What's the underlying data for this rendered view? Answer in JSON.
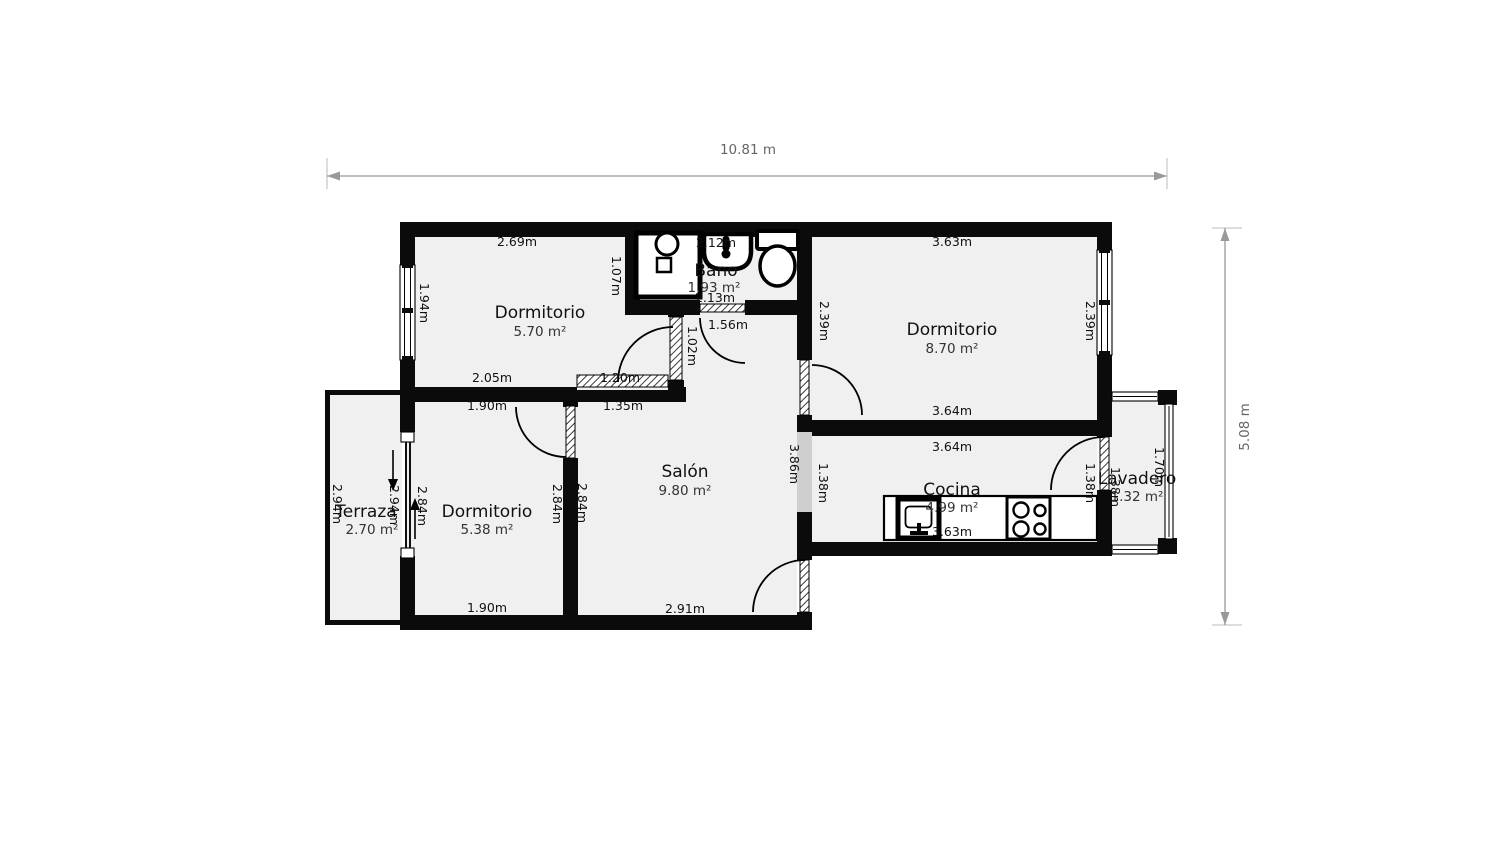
{
  "colors": {
    "wall": "#0b0b0b",
    "floor": "#f0f0f0",
    "passage": "#cfcfcf",
    "dimline": "#999999",
    "dimtext": "#666666",
    "label": "#111111",
    "area": "#333333"
  },
  "overall": {
    "width": "10.81 m",
    "height": "5.08 m"
  },
  "plan": {
    "rooms": {
      "dormitorio_tl": {
        "name": "Dormitorio",
        "area": "5.70 m²",
        "dims": {
          "top": "2.69m",
          "left": "1.94m",
          "right": "1.07m",
          "bottom_left": "2.05m",
          "bottom_right": "1.20m",
          "door": "1.02m"
        }
      },
      "bano": {
        "name": "Bano",
        "area": "1.93 m²",
        "dims": {
          "top": "2.12m",
          "bottom": "2.13m",
          "door": "1.56m"
        }
      },
      "dormitorio_tr": {
        "name": "Dormitorio",
        "area": "8.70 m²",
        "dims": {
          "top": "3.63m",
          "left": "2.39m",
          "right": "2.39m",
          "bottom": "3.64m"
        }
      },
      "salon": {
        "name": "Salón",
        "area": "9.80 m²",
        "dims": {
          "top": "1.35m",
          "left": "2.84m",
          "right": "3.86m",
          "bottom": "2.91m"
        }
      },
      "dormitorio_bl": {
        "name": "Dormitorio",
        "area": "5.38 m²",
        "dims": {
          "top": "1.90m",
          "left": "2.84m",
          "right": "2.84m",
          "bottom": "1.90m"
        }
      },
      "terraza": {
        "name": "Terraza",
        "area": "2.70 m²",
        "dims": {
          "left": "2.94m",
          "right": "2.94m"
        }
      },
      "cocina": {
        "name": "Cocina",
        "area": "4.99 m²",
        "dims": {
          "top": "3.64m",
          "left": "1.38m",
          "right": "1.38m",
          "bottom": "3.63m"
        }
      },
      "lavadero": {
        "name": "Lavadero",
        "area": "1.32 m²",
        "dims": {
          "height": "1.70m",
          "width": "1.38m"
        }
      }
    }
  }
}
